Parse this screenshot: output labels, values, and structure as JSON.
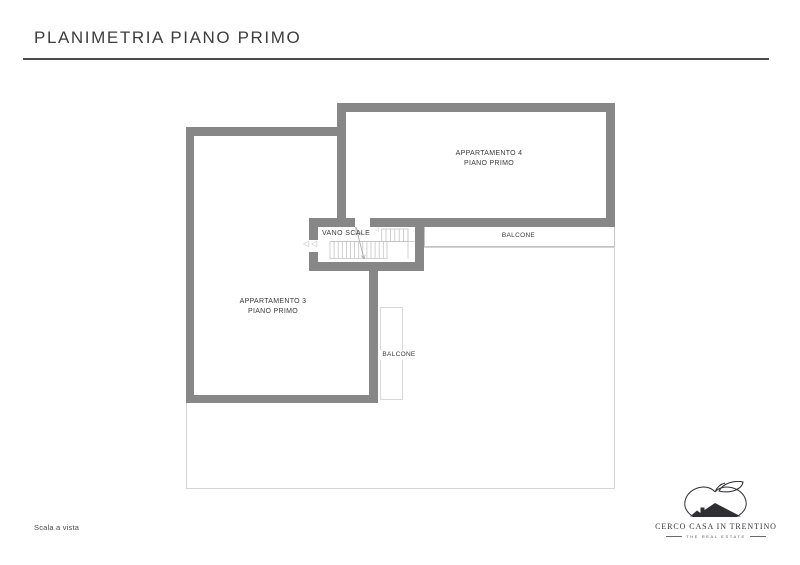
{
  "header": {
    "title": "PLANIMETRIA PIANO PRIMO"
  },
  "plan": {
    "rooms": [
      {
        "id": "apartment-4",
        "name": "APPARTAMENTO 4",
        "floor": "PIANO PRIMO"
      },
      {
        "id": "apartment-3",
        "name": "APPARTAMENTO 3",
        "floor": "PIANO PRIMO"
      },
      {
        "id": "stairwell",
        "name": "VANO SCALE"
      }
    ],
    "balconies": [
      {
        "id": "balcony-top",
        "label": "BALCONE"
      },
      {
        "id": "balcony-side",
        "label": "BALCONE"
      }
    ]
  },
  "footer": {
    "note": "Scala a vista"
  },
  "logo": {
    "name": "CERCO CASA IN TRENTINO",
    "tagline": "THE REAL ESTATE"
  },
  "colors": {
    "wall": "#878787",
    "terrace_outline": "#d4d4d4",
    "balcony_outline": "#c4c4c4",
    "stairs_line": "#c4c4c4",
    "title_text": "#3d3d3d",
    "label_text": "#3a3a3a",
    "rule": "#4a4a4a"
  }
}
